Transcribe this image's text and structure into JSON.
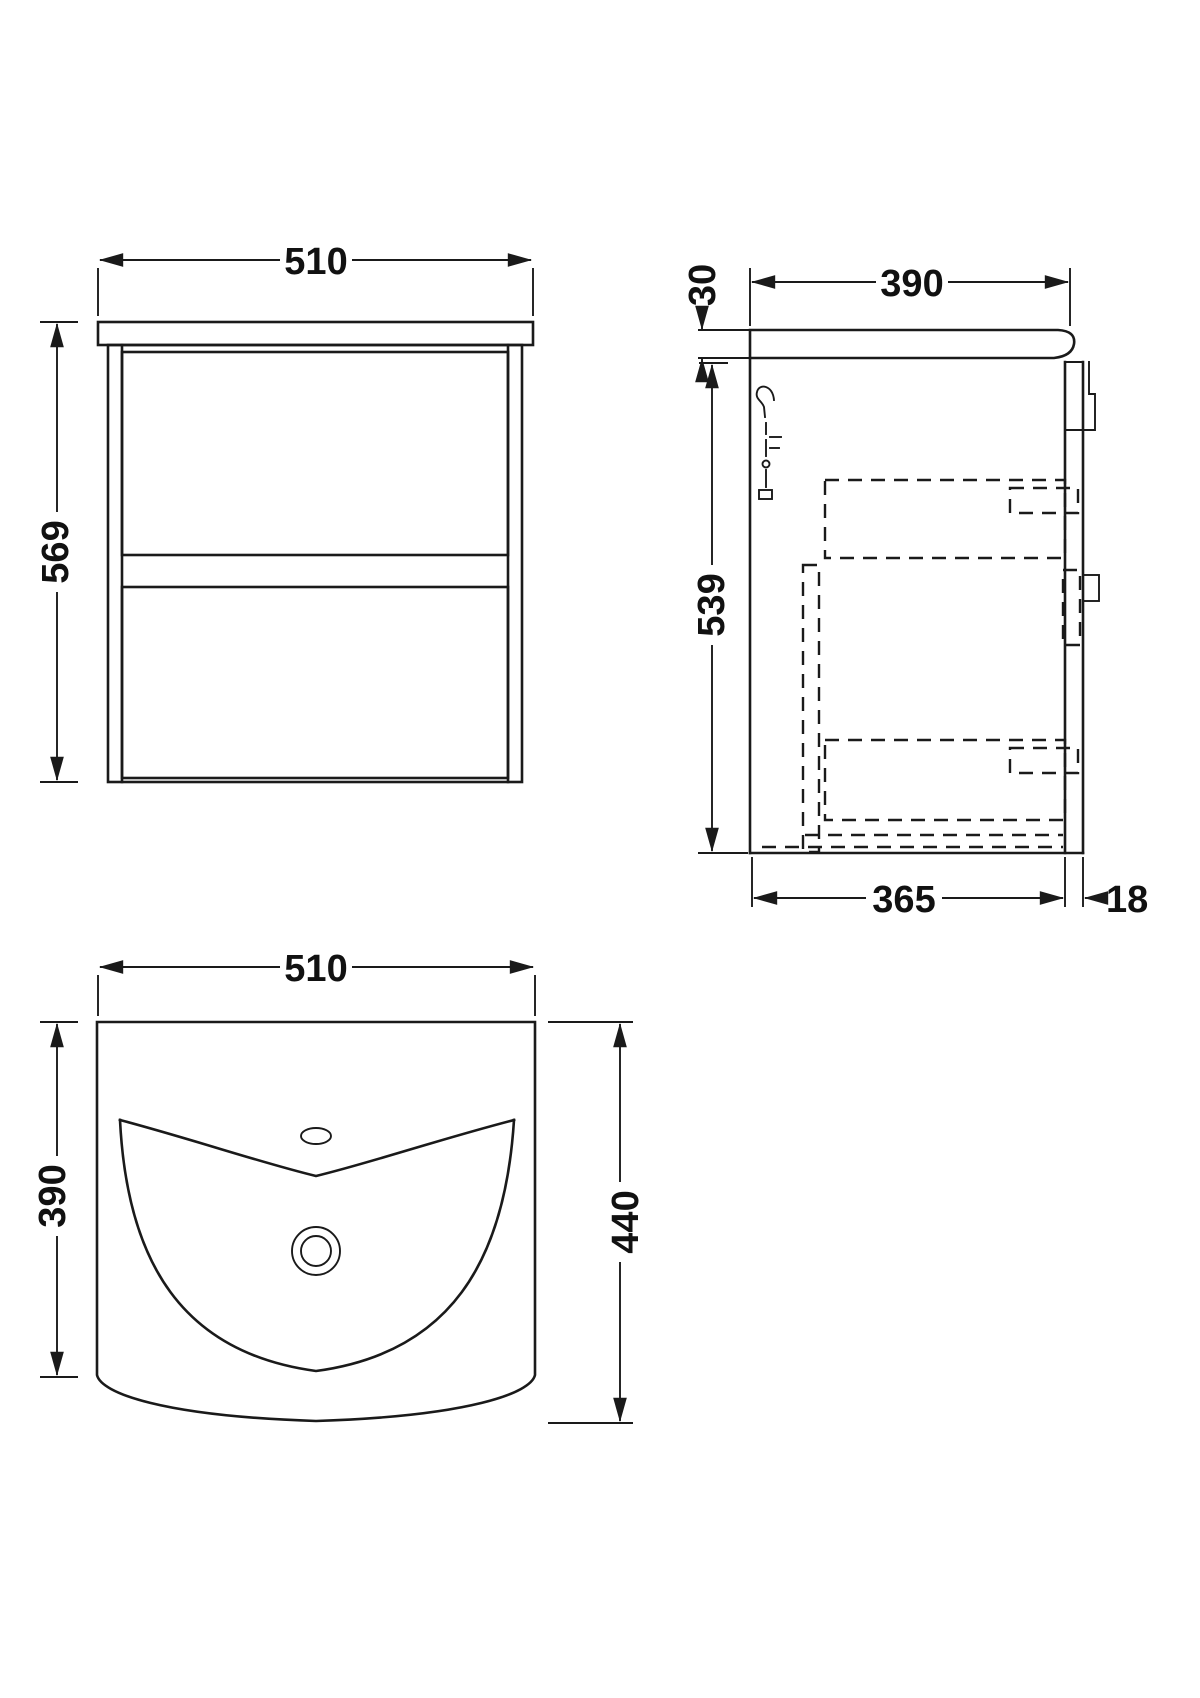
{
  "drawing": {
    "front_view": {
      "width_label": "510",
      "height_label": "569"
    },
    "side_view": {
      "depth_label": "390",
      "counter_thickness_label": "30",
      "body_height_label": "539",
      "internal_depth_label": "365",
      "panel_thickness_label": "18"
    },
    "plan_view": {
      "width_label": "510",
      "depth_label": "390",
      "overall_depth_label": "440"
    }
  },
  "colors": {
    "line": "#1a1a1a",
    "background": "#ffffff"
  }
}
